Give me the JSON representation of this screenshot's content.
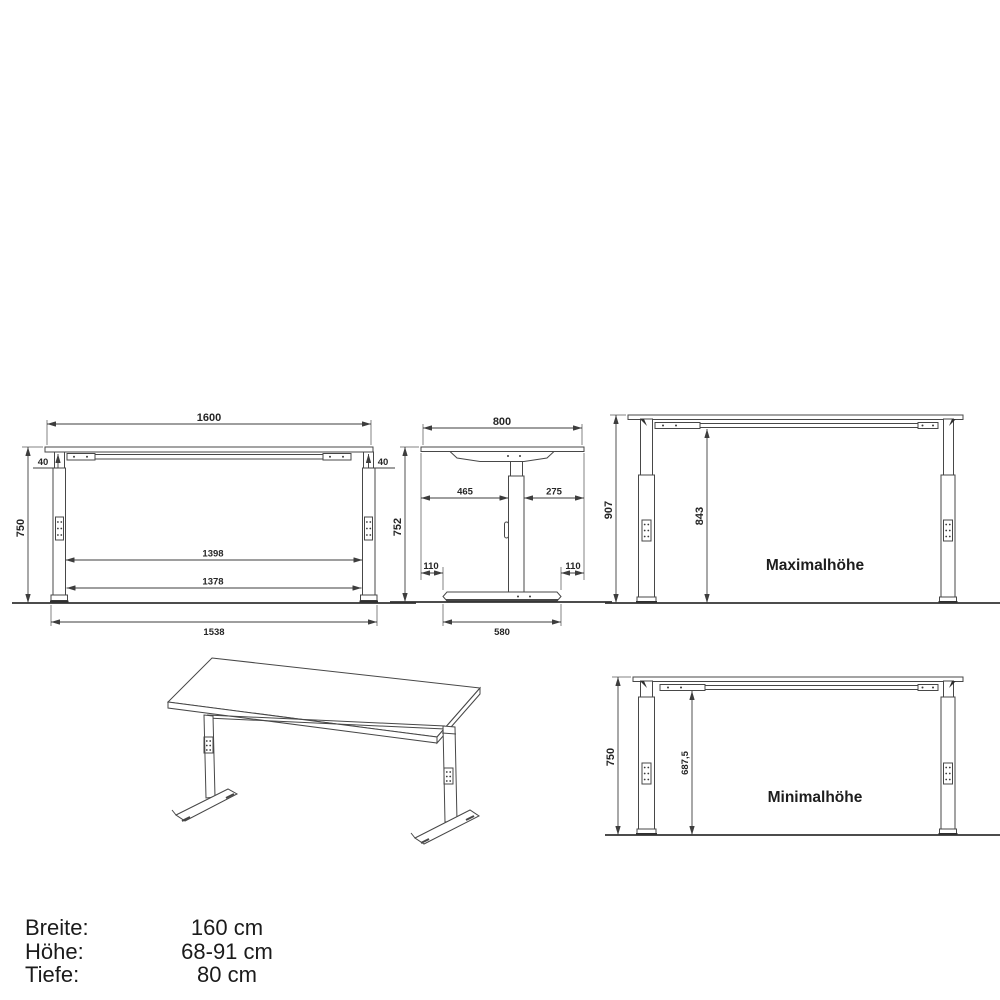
{
  "drawing": {
    "front_view": {
      "top_width": "1600",
      "overhang_left": "40",
      "overhang_right": "40",
      "height": "750",
      "inner_width_top": "1398",
      "inner_width_bottom": "1378",
      "foot_span": "1538"
    },
    "side_view": {
      "top_depth": "800",
      "col_to_front": "465",
      "col_to_back": "275",
      "height": "752",
      "front_overhang": "110",
      "back_overhang": "110",
      "foot_depth": "580"
    },
    "max_view": {
      "label": "Maximalhöhe",
      "total_height": "907",
      "clearance_height": "843"
    },
    "min_view": {
      "label": "Minimalhöhe",
      "total_height": "750",
      "clearance_height": "687,5"
    },
    "colors": {
      "line": "#474747",
      "text": "#262626",
      "background": "#ffffff"
    }
  },
  "specs": {
    "rows": [
      {
        "label": "Breite:",
        "value": "160 cm"
      },
      {
        "label": "Höhe:",
        "value": "68-91 cm"
      },
      {
        "label": "Tiefe:",
        "value": "80 cm"
      }
    ]
  }
}
